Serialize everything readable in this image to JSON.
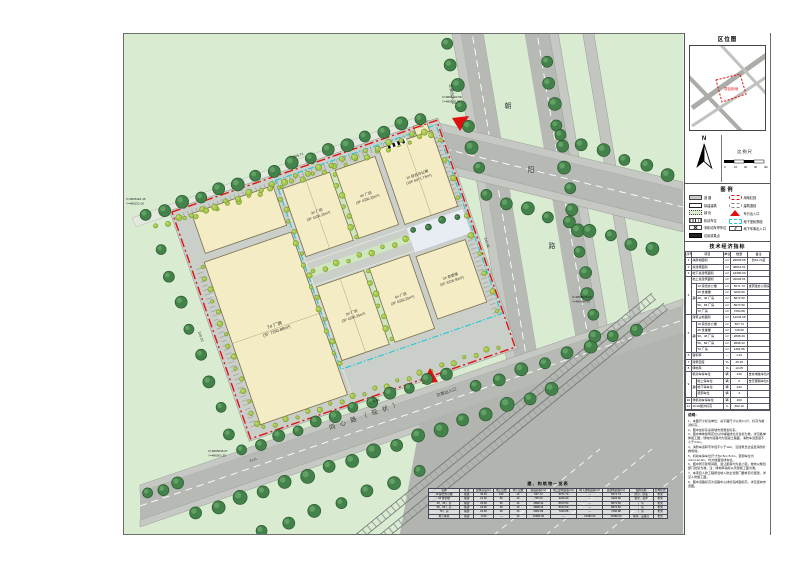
{
  "map": {
    "road_vertical_name": [
      "朝",
      "阳",
      "路"
    ],
    "road_bottom_name": "同心路（现状）",
    "entrance_main": "主要出入口",
    "entrance_secondary": "次要出入口",
    "gatehouse": "门卫",
    "buildings": [
      {
        "name": "3# 厂房",
        "info": "(3F 4336.25m²)"
      },
      {
        "name": "4# 厂房",
        "info": "(3F 4336.25m²)"
      },
      {
        "name": "1# 综合办公楼",
        "info": "(10F 5071.73m²)"
      },
      {
        "name": "5# 厂房",
        "info": "(3F 4336.25m²)"
      },
      {
        "name": "6# 厂房",
        "info": "(3F 4336.25m²)"
      },
      {
        "name": "2# 食堂楼",
        "info": "(5F 3226.90m²)"
      },
      {
        "name": "7# 厂房",
        "info": "(3F 7290.88m²)"
      }
    ],
    "dims": {
      "top": "265.71",
      "right": "241.09",
      "bottom": "279.86",
      "left": "240.15",
      "extra": "37.21"
    },
    "coords": [
      {
        "x": "X=3806118.45",
        "y": "Y=486231.06"
      },
      {
        "x": "X=3806203.58",
        "y": "Y=486512.36"
      },
      {
        "x": "X=3806036.24",
        "y": "Y=486580.62"
      },
      {
        "x": "X=3805948.07",
        "y": "Y=486301.55"
      }
    ]
  },
  "panel": {
    "locmap": {
      "title": "区位图",
      "parcel": "项目用地"
    },
    "compass_n": "N",
    "scale": {
      "label": "比例尺",
      "ticks": [
        "0",
        "10",
        "20",
        "30",
        "40m"
      ]
    },
    "legend": {
      "title": "图例",
      "left": [
        {
          "label": "道  路"
        },
        {
          "label": "拟建建筑"
        },
        {
          "label": "绿  化"
        },
        {
          "label": "机动车位"
        },
        {
          "label": "非机动车停车位"
        },
        {
          "label": "垃圾收集点"
        }
      ],
      "right": [
        {
          "label": "用地红线"
        },
        {
          "label": "建筑退线"
        },
        {
          "label": "车行出入口"
        },
        {
          "label": "地下室轮廓线"
        },
        {
          "label": "地下车库出入口"
        }
      ]
    },
    "table": {
      "title": "技术经济指标",
      "headers": [
        "序号",
        "项目",
        "单位",
        "数量",
        "备注"
      ],
      "qizhong": "其中",
      "rows": [
        {
          "no": "1",
          "name": "净用地面积",
          "unit": "m²",
          "qty": "29806.88",
          "note": "约44.71亩"
        },
        {
          "no": "2",
          "name": "总建筑面积",
          "unit": "m²",
          "qty": "48814.51",
          "note": ""
        },
        {
          "no": "3",
          "name": "地下总建筑面积",
          "unit": "m²",
          "qty": "16380.00",
          "note": ""
        },
        {
          "no": "4",
          "name": "地上总建筑面积",
          "unit": "m²",
          "qty": "32934.51",
          "note": ""
        },
        {
          "name": "1# 综合办公楼",
          "unit": "m²",
          "qty": "5071.73",
          "note": "含研发办公用房"
        },
        {
          "name": "2# 食堂楼",
          "unit": "m²",
          "qty": "3226.90",
          "note": ""
        },
        {
          "name": "3#、4# 厂房",
          "unit": "m²",
          "qty": "8672.50",
          "note": ""
        },
        {
          "name": "5#、6# 厂房",
          "unit": "m²",
          "qty": "8672.50",
          "note": ""
        },
        {
          "name": "7# 厂房",
          "unit": "m²",
          "qty": "7290.88",
          "note": ""
        },
        {
          "no": "5",
          "name": "建筑占地面积",
          "unit": "m²",
          "qty": "12034.98",
          "note": ""
        },
        {
          "name": "1# 综合办公楼",
          "unit": "m²",
          "qty": "567.73",
          "note": ""
        },
        {
          "name": "2# 食堂楼",
          "unit": "m²",
          "qty": "728.00",
          "note": ""
        },
        {
          "name": "3#、4# 厂房",
          "unit": "m²",
          "qty": "2898.43",
          "note": ""
        },
        {
          "name": "5#、6# 厂房",
          "unit": "m²",
          "qty": "2898.43",
          "note": ""
        },
        {
          "name": "7# 厂房",
          "unit": "m²",
          "qty": "1481.86",
          "note": ""
        },
        {
          "no": "6",
          "name": "容积率",
          "unit": "—",
          "qty": "1.10",
          "note": ""
        },
        {
          "no": "7",
          "name": "建筑密度",
          "unit": "%",
          "qty": "40.39",
          "note": ""
        },
        {
          "no": "8",
          "name": "绿地率",
          "unit": "%",
          "qty": "12.05",
          "note": ""
        },
        {
          "no": "9",
          "name": "机动车停车位",
          "unit": "辆",
          "qty": "249",
          "note": "含充电桩车位35个"
        },
        {
          "name": "地上停车位",
          "unit": "辆",
          "qty": "6",
          "note": "含无障碍车位1个"
        },
        {
          "name": "地下停车位",
          "unit": "辆",
          "qty": "243",
          "note": ""
        },
        {
          "name": "装卸车位",
          "unit": "辆",
          "qty": "4",
          "note": ""
        },
        {
          "no": "10",
          "name": "非机动车停车位",
          "unit": "辆",
          "qty": "400",
          "note": ""
        },
        {
          "no": "11",
          "name": "±0.00绝对标高",
          "unit": "m",
          "qty": "662.10",
          "note": ""
        }
      ]
    },
    "notes": {
      "title": "说明：",
      "items": [
        "1、本图尺寸标注单位：总平面尺寸以米(m)计，标高为绝对标高。",
        "2、图中坐标系采用城市测量坐标系。",
        "3、图中单体建筑定位以外墙轴线交点坐标为准，详见各单体施工图；场地内道路均为混凝土路面，消防车道宽度不小于4.0m。",
        "4、消防车道转弯半径不小于12m，沿建筑长边设置消防扑救场地。",
        "5、机动车停车位尺寸为2.5m×5.3m，装卸车位为4.0m×12.0m，均为地面划线车位。",
        "6、图中所示建筑间距、退让距离均为最小值，放线以规划部门批复为准。注：绿地率指标以景观施工图为准。",
        "7、本项目人防工程按当地人防主管部门要求另行报建，详见人防施工图。",
        "8、图中道路标高为道路中心线处完成面标高，详见竖向布置图。"
      ]
    }
  },
  "schedule": {
    "title": "建、构筑物一览表",
    "headers": [
      "名称",
      "性质",
      "建筑高度(m)",
      "地上层数",
      "地下层数",
      "基底面积(m²)",
      "地上建筑面积(m²)",
      "地下建筑面积(m²)",
      "总建筑面积(m²)",
      "使用功能",
      "结构形式"
    ],
    "rows": [
      [
        "1# 综合办公楼",
        "拟建",
        "45.45",
        "10F",
        "1F",
        "567.73",
        "5071.73",
        "—",
        "5071.73",
        "办公、研发",
        "框架"
      ],
      [
        "2# 食堂楼",
        "拟建",
        "21.60",
        "5F",
        "1F",
        "728.00",
        "3226.90",
        "—",
        "3226.90",
        "食堂、宿舍",
        "框架"
      ],
      [
        "3#、4# 厂房",
        "拟建",
        "23.60",
        "3F",
        "1F",
        "2898.43",
        "8672.50",
        "—",
        "8672.50",
        "厂房",
        "框架"
      ],
      [
        "5#、6# 厂房",
        "拟建",
        "23.60",
        "3F",
        "1F",
        "2898.43",
        "8672.50",
        "—",
        "8672.50",
        "厂房",
        "框架"
      ],
      [
        "7# 厂房",
        "拟建",
        "23.60",
        "3F",
        "1F",
        "2952.86",
        "7290.88",
        "—",
        "7290.88",
        "厂房",
        "框架"
      ],
      [
        "地下车库",
        "拟建",
        "-5.90",
        "—",
        "1F",
        "16380.00",
        "—",
        "16380.00",
        "16380.00",
        "车库、设备房",
        "框剪"
      ]
    ]
  }
}
